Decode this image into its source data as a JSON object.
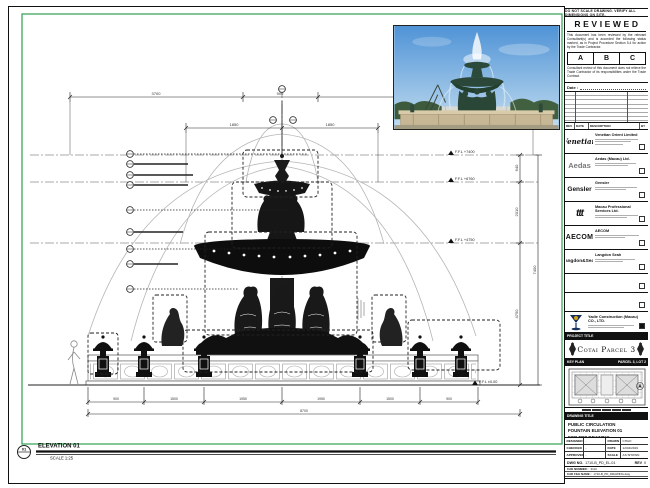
{
  "sheet": {
    "border_note": "DO NOT SCALE DRAWING. VERIFY ALL DIMENSIONS ON SITE.",
    "elevation": {
      "marker": "01",
      "label": "ELEVATION 01",
      "scale": "SCALE 1:25"
    }
  },
  "stamp": {
    "title": "REVIEWED",
    "body1": "This document has been reviewed by the relevant Consultant(s) and is accorded the following status marked, as in Project Procedure Section 5.4 for action by the Trade Contractor.",
    "grades": [
      "A",
      "B",
      "C"
    ],
    "body2": "Consultant review of this document does not relieve the Trade Contractor of its responsibilities under the Trade Contract.",
    "date_label": "Date :"
  },
  "revisions": {
    "headers": {
      "rev": "REV",
      "date": "DATE",
      "description": "DESCRIPTION",
      "by": "BY"
    }
  },
  "consultants": [
    {
      "logo": "Venetian",
      "name": "Venetian Orient Limited"
    },
    {
      "logo": "Aedas",
      "name": "Aedas (Macau) Ltd."
    },
    {
      "logo": "Gensler",
      "name": "Gensler"
    },
    {
      "logo": "ttt",
      "name": "Macau Professional Services Ltd."
    },
    {
      "logo": "AECOM",
      "name": "AECOM"
    },
    {
      "logo": "Langdon&Seah",
      "name": "Langdon Seah"
    }
  ],
  "contractor": {
    "name": "Yadie Construction (Macau) CO., LTD."
  },
  "project": {
    "strip_label": "PROJECT TITLE",
    "name": "Cotai Parcel 3"
  },
  "key_plan": {
    "strip_label": "KEY PLAN",
    "right_label": "PARCEL 3, LOT 2"
  },
  "drawing_title": {
    "strip_label": "DRAWING TITLE",
    "line1": "PUBLIC CIRCULATION",
    "line2": "FOUNTAIN ELEVATION 01",
    "line3": "FOR FRP DRAWING"
  },
  "signoff": {
    "designed_label": "DESIGNED",
    "designed": "-",
    "drawn_label": "DRAWN",
    "drawn": "CHAO",
    "checked_label": "CHECKED",
    "checked": "-",
    "date_label": "DATE",
    "date": "12/04/2019",
    "approved_label": "APPROVED",
    "approved": "-",
    "scale_label": "SCALE",
    "scale": "AS SHOWN"
  },
  "doc_numbers": {
    "dwg_label": "DWG NO.",
    "dwg_value": "1710-B_PD_EL-01",
    "rev_label": "REV",
    "rev_value": "0",
    "cad_number_label": "CAD NUMBER :",
    "cad_number_value": "3110",
    "cad_file_label": "CAD FILE NAME :",
    "cad_file_value": "1710-B_PD_DRAWING.dwg",
    "ref_label": "REFERENCE CAD FILE NAME :",
    "ref_value": "-"
  },
  "levels": {
    "l1": "F.F.L +7400",
    "l2": "F.F.L +6760",
    "l3": "F.F.L +4750",
    "l0": "F.F.L ±0.00"
  },
  "dims": {
    "top": [
      "3700",
      "900",
      "3700"
    ],
    "mid": [
      "1850",
      "1850"
    ],
    "right": [
      "640",
      "2010",
      "4750"
    ],
    "right_total": "7400",
    "bottom": [
      "900",
      "1500",
      "1950",
      "1950",
      "1500",
      "900"
    ],
    "bottom_total": "8700"
  }
}
